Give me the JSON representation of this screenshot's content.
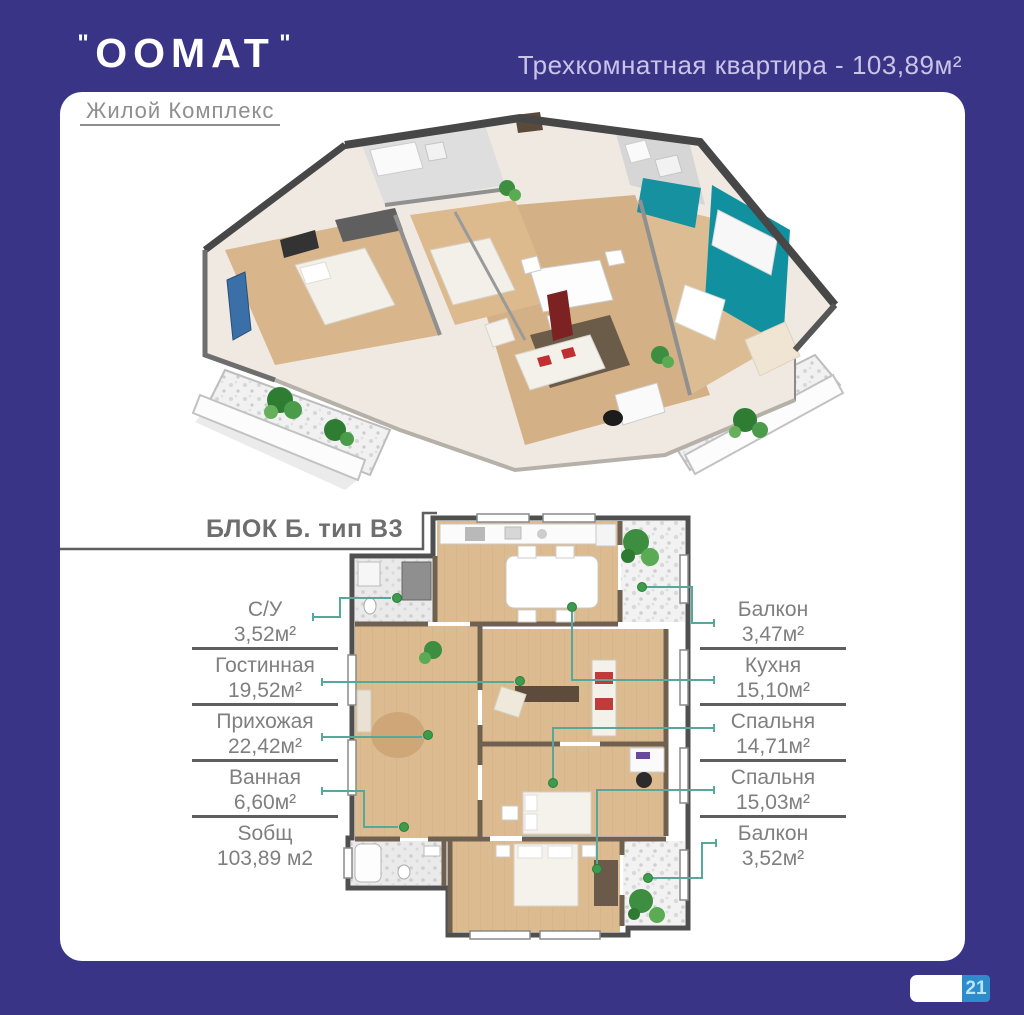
{
  "header": {
    "open_quote": "\"",
    "logo_text": "OOMAT",
    "close_quote": "\"",
    "subtitle": "Жилой Комплекс",
    "apartment_title": "Трехкомнатная квартира - 103,89м²"
  },
  "section": {
    "block_label": "БЛОК Б. тип В3"
  },
  "floorplan_labels": {
    "left": [
      {
        "name": "С/У",
        "area": "3,52м²"
      },
      {
        "name": "Гостинная",
        "area": "19,52м²"
      },
      {
        "name": "Прихожая",
        "area": "22,42м²"
      },
      {
        "name": "Ванная",
        "area": "6,60м²"
      },
      {
        "name": "Sобщ",
        "area": "103,89 м2"
      }
    ],
    "right": [
      {
        "name": "Балкон",
        "area": "3,47м²"
      },
      {
        "name": "Кухня",
        "area": "15,10м²"
      },
      {
        "name": "Спальня",
        "area": "14,71м²"
      },
      {
        "name": "Спальня",
        "area": "15,03м²"
      },
      {
        "name": "Балкон",
        "area": "3,52м²"
      }
    ]
  },
  "footer": {
    "page_number": "21"
  },
  "colors": {
    "background_purple": "#3a3486",
    "title_lavender": "#cac4e9",
    "text_gray": "#7f7f7f",
    "accent_teal": "#15919f",
    "callout_teal": "#57a79b",
    "dot_green": "#3c9b4c",
    "badge_blue": "#2e8ccd",
    "wood_floor": "#d9b88e",
    "wall_dark": "#4f4f4f"
  }
}
